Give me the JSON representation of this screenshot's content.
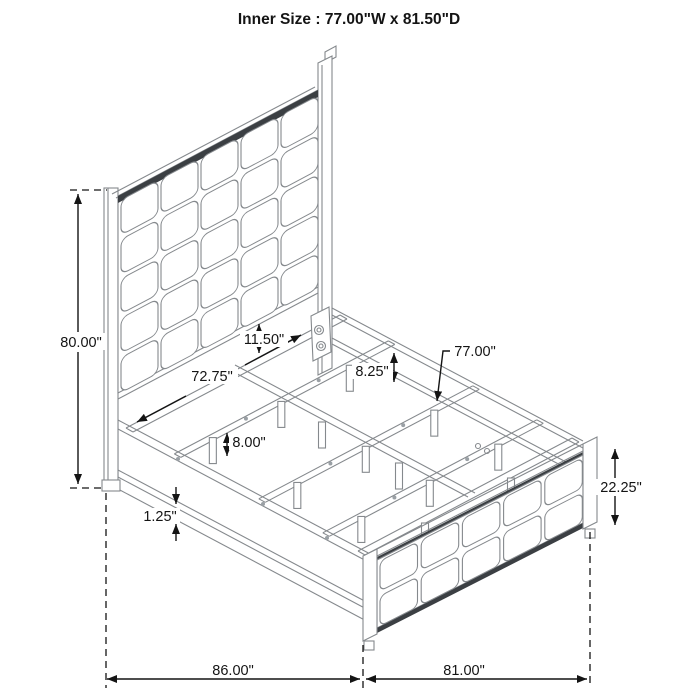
{
  "title": "Inner Size : 77.00\"W x 81.50\"D",
  "dimensions": {
    "headboard_height": "80.00\"",
    "side_rail_inner_length": "72.75\"",
    "panel_to_rail_gap": "11.50\"",
    "rail_top_to_slat_ledge": "8.25\"",
    "slat_inner_width": "77.00\"",
    "slat_leg_height": "8.00\"",
    "rail_bottom_trim": "1.25\"",
    "footboard_height": "22.25\"",
    "overall_length": "86.00\"",
    "overall_width": "81.00\""
  }
}
